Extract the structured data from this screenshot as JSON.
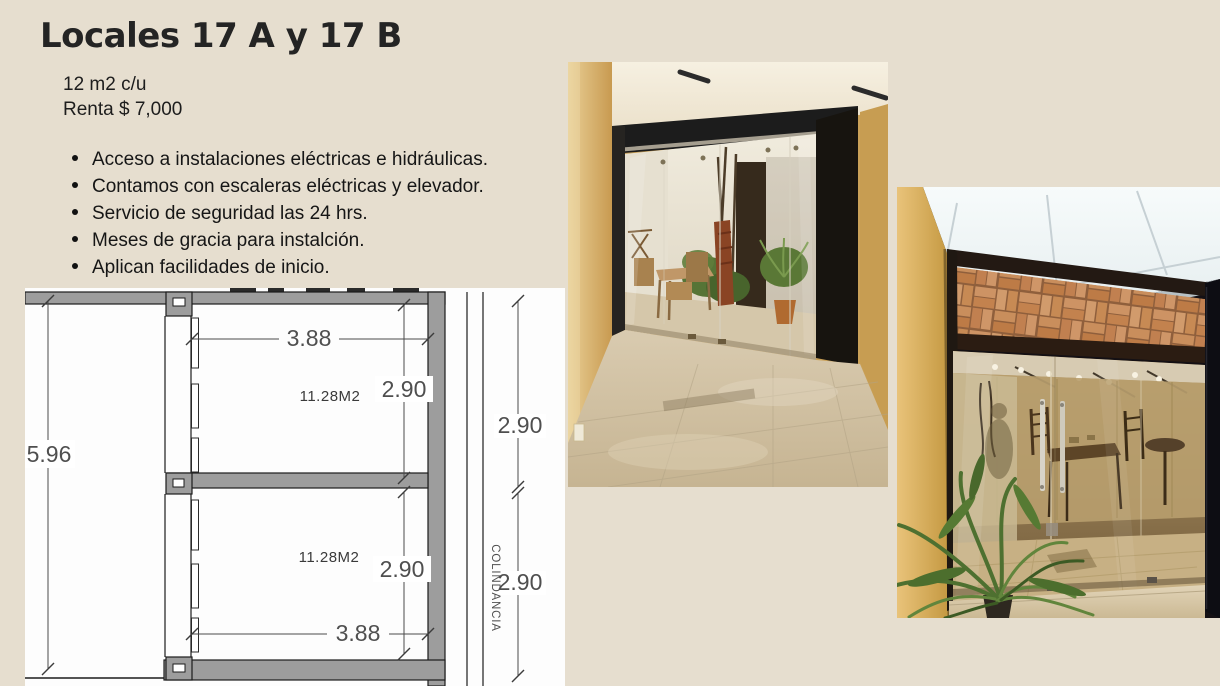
{
  "colors": {
    "background": "#e6decf",
    "title_text": "#242424",
    "body_text": "#161616",
    "plan_wall": "#9d9d9d"
  },
  "header": {
    "title": "Locales 17 A y 17 B",
    "size_line": "12 m2 c/u",
    "rent_line": "Renta $ 7,000"
  },
  "features": [
    "Acceso a instalaciones eléctricas e hidráulicas.",
    "Contamos con escaleras eléctricas y elevador.",
    "Servicio de seguridad las 24 hrs.",
    "Meses de gracia para instalción.",
    "Aplican facilidades de inicio."
  ],
  "floor_plan": {
    "rooms": [
      {
        "area": "11.28M2",
        "width": "3.88",
        "height": "2.90"
      },
      {
        "area": "11.28M2",
        "width": "3.88",
        "height": "2.90"
      }
    ],
    "total_height": "5.96",
    "right_dims": [
      "2.90",
      "2.90"
    ],
    "boundary_label": "COLINDANCIA"
  }
}
